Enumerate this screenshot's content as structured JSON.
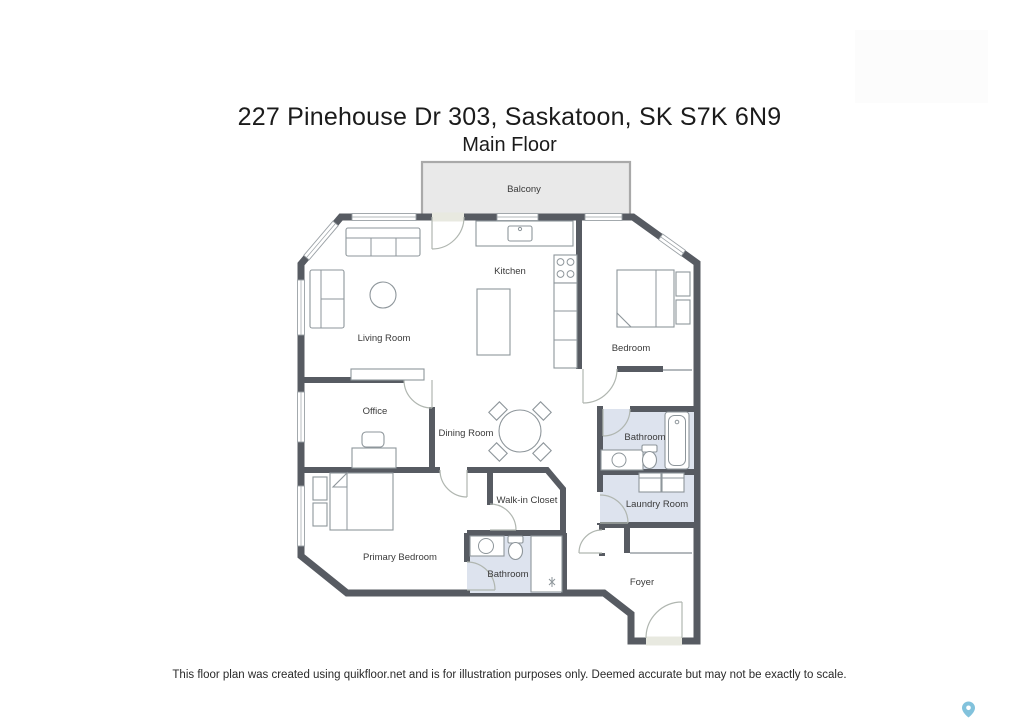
{
  "page": {
    "title": "227 Pinehouse Dr 303, Saskatoon, SK S7K 6N9",
    "subtitle": "Main Floor",
    "disclaimer": "This floor plan was created using quikfloor.net and is for illustration purposes only. Deemed accurate but may not be exactly to scale."
  },
  "floor_plan": {
    "rooms": [
      {
        "name": "Balcony"
      },
      {
        "name": "Kitchen"
      },
      {
        "name": "Living Room"
      },
      {
        "name": "Bedroom"
      },
      {
        "name": "Office"
      },
      {
        "name": "Dining Room"
      },
      {
        "name": "Bathroom"
      },
      {
        "name": "Walk-in Closet"
      },
      {
        "name": "Laundry Room"
      },
      {
        "name": "Primary Bedroom"
      },
      {
        "name": "Bathroom"
      },
      {
        "name": "Foyer"
      }
    ],
    "colors": {
      "wall": "#575b62",
      "floor": "#e8e9e0",
      "tile": "#dde3ee",
      "balcony": "#e9e9e9",
      "balcony_border": "#a9a9a9",
      "map_pin": "#6cb7d6"
    }
  }
}
